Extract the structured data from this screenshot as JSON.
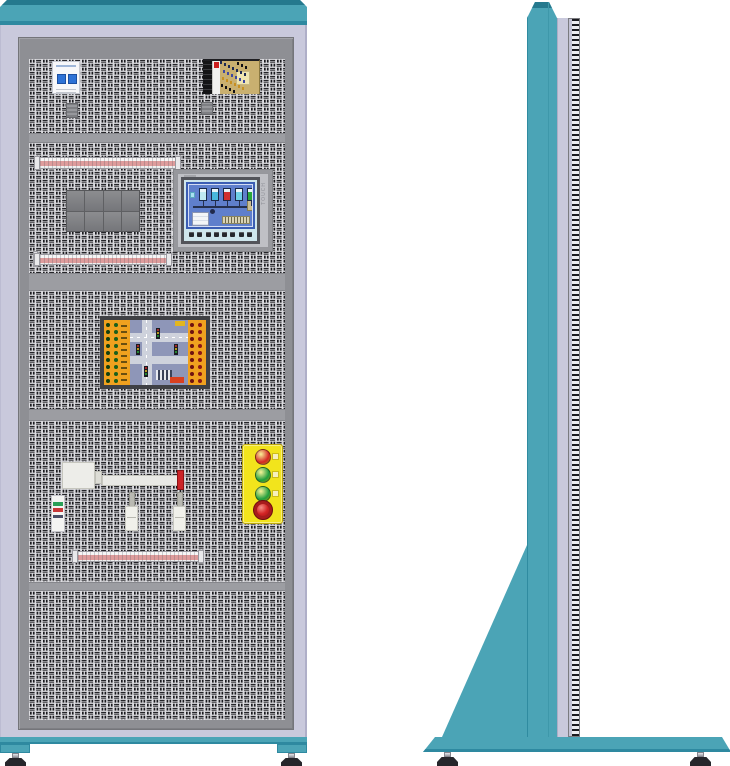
{
  "palette": {
    "teal": "#4BA4B6",
    "teal_dark": "#2E89A0",
    "teal_edge": "#25798E",
    "lavender": "#C9C9DC",
    "frame_gray": "#8E8F94",
    "divider_gray": "#9C9DA2",
    "perf_bg": "#DCDCE0",
    "perf_mark": "#1A1A1E",
    "station_yellow": "#F2E41C",
    "estop_ring": "#A81C1C",
    "strip_stripe": "#DE9C9C",
    "orange": "#F0A11F",
    "board_frame": "#3F4044",
    "board_blue": "#8E96B8",
    "road_gray": "#CED2DC",
    "tag_red": "#D84020",
    "tag_yellow": "#E2B61E",
    "hmi_screen": "#3B5EB4",
    "hmi_panel": "#5F7FCC",
    "hmi_cyan": "#CFE6EC",
    "psu_board": "#C9B070",
    "toggle_blue": "#2E72D6"
  },
  "front": {
    "hmi": {
      "side_label": "TOUCH",
      "function_keys": 8,
      "tank_colors": [
        "#BFE9F2",
        "#49B7DC",
        "#D03030",
        "#6FD0E6",
        "#2AA83A"
      ]
    },
    "contactors": {
      "rows": 2,
      "cols": 4
    },
    "traffic_board": {
      "dot_rows": 9,
      "left_dot_colors": [
        "#12400F",
        "#1A5F1C"
      ],
      "right_dot_colors": [
        "#6E1210",
        "#8A1815"
      ],
      "signal_colors": [
        "#D03030",
        "#E8C020",
        "#28A838"
      ],
      "label_dashes": 10
    },
    "button_station": {
      "buttons": [
        {
          "name": "red-pushbutton",
          "color": "#D42525",
          "estop": false
        },
        {
          "name": "green-pushbutton",
          "color": "#1F9E3E",
          "estop": false
        },
        {
          "name": "green-pushbutton-2",
          "color": "#1F9E3E",
          "estop": false
        },
        {
          "name": "emergency-stop-button",
          "color": "#D42525",
          "estop": true
        }
      ]
    }
  }
}
